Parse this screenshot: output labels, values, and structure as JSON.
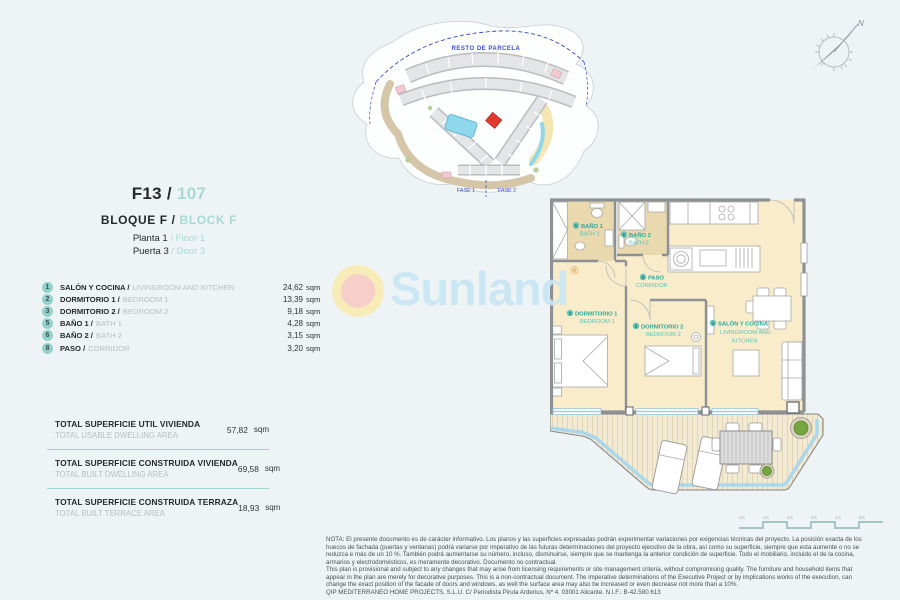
{
  "accent": {
    "teal_light": "#a5dad4",
    "teal_label": "#3fbdb0",
    "badge_bg": "#93d2cb",
    "red_unit": "#e23a2e",
    "window_blue": "#a3cfe6"
  },
  "header": {
    "unit_es": "F13 /",
    "unit_en": "107",
    "block_es": "BLOQUE F",
    "slash": "/",
    "block_en": "BLOCK F",
    "floor_es": "Planta 1",
    "floor_sep": "/",
    "floor_en": "Floor 1",
    "door_es": "Puerta 3",
    "door_sep": "/",
    "door_en": "Door 3"
  },
  "rooms": [
    {
      "num": "1",
      "es": "SALÓN Y COCINA /",
      "en": "LIVINGROOM AND KITCHEN",
      "area": "24,62",
      "unit": "sqm"
    },
    {
      "num": "2",
      "es": "DORMITORIO 1 /",
      "en": "BEDROOM 1",
      "area": "13,39",
      "unit": "sqm"
    },
    {
      "num": "3",
      "es": "DORMITORIO 2 /",
      "en": "BEDROOM 2",
      "area": "9,18",
      "unit": "sqm"
    },
    {
      "num": "5",
      "es": "BAÑO 1 /",
      "en": "BATH 1",
      "area": "4,28",
      "unit": "sqm"
    },
    {
      "num": "6",
      "es": "BAÑO 2 /",
      "en": "BATH 2",
      "area": "3,15",
      "unit": "sqm"
    },
    {
      "num": "8",
      "es": "PASO /",
      "en": "CORRIDOR",
      "area": "3,20",
      "unit": "sqm"
    }
  ],
  "totals": [
    {
      "es": "TOTAL SUPERFICIE UTIL VIVIENDA",
      "en": "TOTAL USABLE DWELLING AREA",
      "area": "57,82",
      "unit": "sqm"
    },
    {
      "es": "TOTAL SUPERFICIE CONSTRUIDA VIVIENDA",
      "en": "TOTAL BUILT DWELLING AREA",
      "area": "69,58",
      "unit": "sqm"
    },
    {
      "es": "TOTAL SUPERFICIE CONSTRUIDA TERRAZA",
      "en": "TOTAL BUILT TERRACE AREA",
      "area": "18,93",
      "unit": "sqm"
    }
  ],
  "site_plan": {
    "parcel_label": "RESTO DE PARCELA",
    "fase1": "FASE 1",
    "fase2": "FASE 2"
  },
  "compass": {
    "north": "N"
  },
  "floor_plan": {
    "bath1_num": "5",
    "bath1_es": "BAÑO 1",
    "bath1_en": "BATH 1",
    "bath2_num": "6",
    "bath2_es": "BAÑO 2",
    "bath2_en": "BATH 2",
    "paso_num": "8",
    "paso_es": "PASO",
    "paso_en": "CORRIDOR",
    "bed1_num": "2",
    "bed1_es": "DORMITORIO 1",
    "bed1_en": "BEDROOM 1",
    "bed2_num": "3",
    "bed2_es": "DORMITORIO 2",
    "bed2_en": "BEDROOM 2",
    "salon_num": "1",
    "salon_es": "SALÓN Y COCINA",
    "salon_en1": "LIVINGROOM AND",
    "salon_en2": "KITCHEN"
  },
  "watermark": {
    "brand": "Sunland",
    "reg": "®"
  },
  "scale_bar": {
    "labels": [
      "0m",
      "1m",
      "2m",
      "3m",
      "4m",
      "5m"
    ]
  },
  "legal": {
    "lines": [
      "NOTA: El presente documento es de carácter informativo. Los planos y las superficies expresadas podrán experimentar variaciones por exigencias técnicas del proyecto. La posición exacta de los",
      "huecos de fachada (puertas y ventanas) podrá variarse por imperativo de las futuras determinaciones del proyecto ejecutivo de la obra, así como su superficie, siempre que esta aumente o no se",
      "reduzca e más de un 10 %. También podrá aumentarse su número, incluso, disminuirse, siempre que se mantenga la anterior condición de superficie. Todo el mobiliario, incluido el de la cocina,",
      "armarios y electrodomésticos, es meramente decorativo. Documento no contractual.",
      "This plan is provisional and subject to any changes that may arise from licensing requirements or site management criteria, without compromising quality. The furniture and household items that",
      "appear in the plan are merely for decorative purposes. This is a non-contractual document. The imperative determinations of the Executive Project or by implications works of the execution, can",
      "change the exact position of the facade of doors and windows, as well the surface area may also be increased or even decrease not more than a 10%.",
      "QIP MEDITERRÁNEO HOME PROJECTS, S.L.U. C/ Periodista Pirula Arderius, Nº 4. 03001 Alicante. N.I.F.: B-42.580.613"
    ]
  }
}
